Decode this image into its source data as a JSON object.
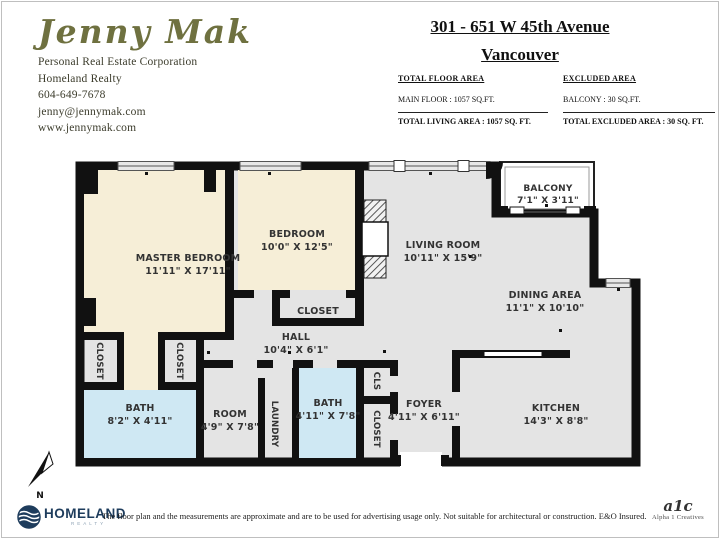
{
  "colors": {
    "wall": "#111111",
    "floor_common": "#e4e4e4",
    "floor_bedroom": "#f6eed7",
    "floor_bath": "#cfe8f3",
    "window": "#e8e8e8",
    "brand_navy": "#1e3c5c",
    "brand_light_blue": "#8fa3b5",
    "logo_olive": "#6f7140"
  },
  "agent": {
    "name": "Jenny Mak",
    "title": "Personal Real Estate Corporation",
    "company": "Homeland Realty",
    "phone": "604-649-7678",
    "email": "jenny@jennymak.com",
    "website": "www.jennymak.com"
  },
  "listing": {
    "address": "301 - 651 W 45th Avenue",
    "city": "Vancouver"
  },
  "area_summary": {
    "floor": {
      "heading": "TOTAL FLOOR AREA",
      "detail": "MAIN FLOOR : 1057 SQ.FT.",
      "total": "TOTAL LIVING AREA : 1057 SQ. FT."
    },
    "excluded": {
      "heading": "EXCLUDED AREA",
      "detail": "BALCONY : 30 SQ.FT.",
      "total": "TOTAL EXCLUDED AREA : 30 SQ. FT."
    }
  },
  "rooms": {
    "master_bedroom": {
      "name": "MASTER BEDROOM",
      "dims": "11'11\" X 17'11\""
    },
    "bedroom": {
      "name": "BEDROOM",
      "dims": "10'0\" X 12'5\""
    },
    "bedroom_closet": {
      "name": "CLOSET"
    },
    "hall": {
      "name": "HALL",
      "dims": "10'4\" X 6'1\""
    },
    "living_room": {
      "name": "LIVING ROOM",
      "dims": "10'11\" X 15'9\""
    },
    "balcony": {
      "name": "BALCONY",
      "dims": "7'1\" X 3'11\""
    },
    "dining_area": {
      "name": "DINING AREA",
      "dims": "11'1\" X 10'10\""
    },
    "kitchen": {
      "name": "KITCHEN",
      "dims": "14'3\" X 8'8\""
    },
    "foyer": {
      "name": "FOYER",
      "dims": "4'11\" X 6'11\""
    },
    "bath_main": {
      "name": "BATH",
      "dims": "8'2\" X 4'11\""
    },
    "room": {
      "name": "ROOM",
      "dims": "4'9\" X 7'8\""
    },
    "bath_second": {
      "name": "BATH",
      "dims": "4'11\" X 7'8\""
    },
    "closet_left_a": {
      "name": "CLOSET"
    },
    "closet_left_b": {
      "name": "CLOSET"
    },
    "laundry": {
      "name": "LAUNDRY"
    },
    "cls": {
      "name": "CLS"
    },
    "foyer_closet": {
      "name": "CLOSET"
    }
  },
  "compass": {
    "label": "N"
  },
  "footer": {
    "brand": "HOMELAND",
    "brand_sub": "REALTY",
    "disclaimer": "The floor plan and the measurements are approximate and are to be used for advertising usage only. Not suitable for architectural or construction. E&O Insured.",
    "credit_mark": "a1c",
    "credit_name": "Alpha 1 Creatives"
  }
}
